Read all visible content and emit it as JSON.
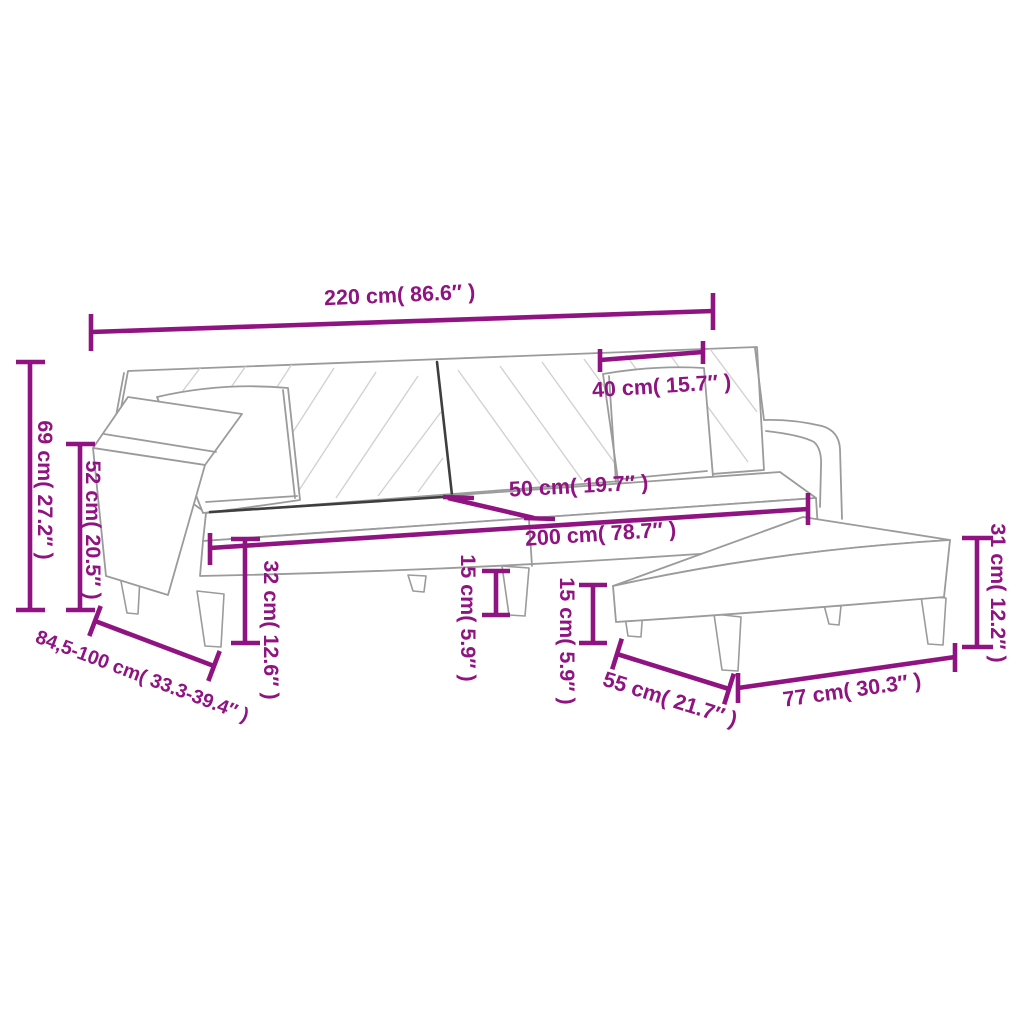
{
  "diagram": {
    "kind": "product-dimension-diagram",
    "product": "sofa-bed-with-pillows-and-footstool",
    "background": "#ffffff",
    "accent_color": "#8F1380",
    "outline_color": "#9b9b9b",
    "dark_seam_color": "#3e3e3e",
    "labels": {
      "overall_width": "220 cm( 86.6″ )",
      "pillow_width": "40 cm( 15.7″ )",
      "back_height": "69 cm( 27.2″ )",
      "armrest_height": "52 cm( 20.5″ )",
      "depth_range": "84,5-100 cm( 33.3-39.4″ )",
      "seat_height": "32 cm( 12.6″ )",
      "seat_width": "200 cm( 78.7″ )",
      "seat_depth": "50 cm( 19.7″ )",
      "sofa_leg_height": "15 cm( 5.9″ )",
      "footstool_leg_height": "15 cm( 5.9″ )",
      "footstool_depth": "55 cm( 21.7″ )",
      "footstool_width": "77 cm( 30.3″ )",
      "footstool_height": "31 cm( 12.2″ )"
    }
  }
}
